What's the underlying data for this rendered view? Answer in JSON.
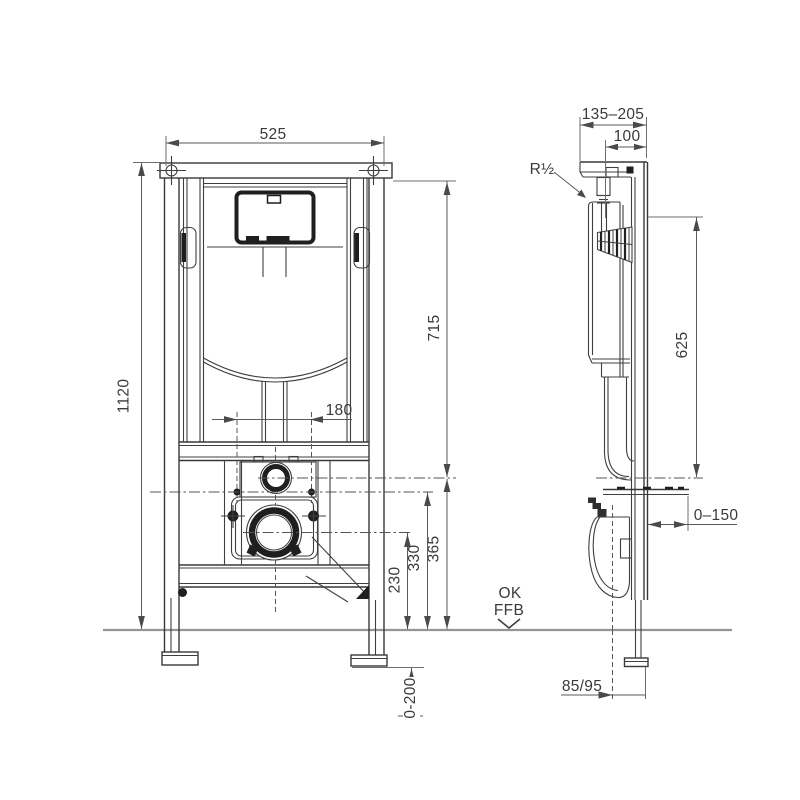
{
  "labels": {
    "front": {
      "width": "525",
      "height": "1120",
      "right_height": "715",
      "bolt_spacing": "180",
      "flush_pipe_height": "365",
      "bolt_height": "330",
      "outlet_height": "230",
      "foot_adjust": "0-200"
    },
    "side": {
      "depth_range": "135–205",
      "depth": "100",
      "water_thread": "R½",
      "tank_to_outlet": "625",
      "wall_distance": "0–150",
      "outlet_offset": "85/95"
    },
    "floor": {
      "line1": "OK",
      "line2": "FFB"
    }
  },
  "colors": {
    "line": "#3f3f3f",
    "heavy": "#1f1f1f",
    "dimension": "#5a5a5a",
    "floor": "#949494",
    "background": "#ffffff"
  }
}
